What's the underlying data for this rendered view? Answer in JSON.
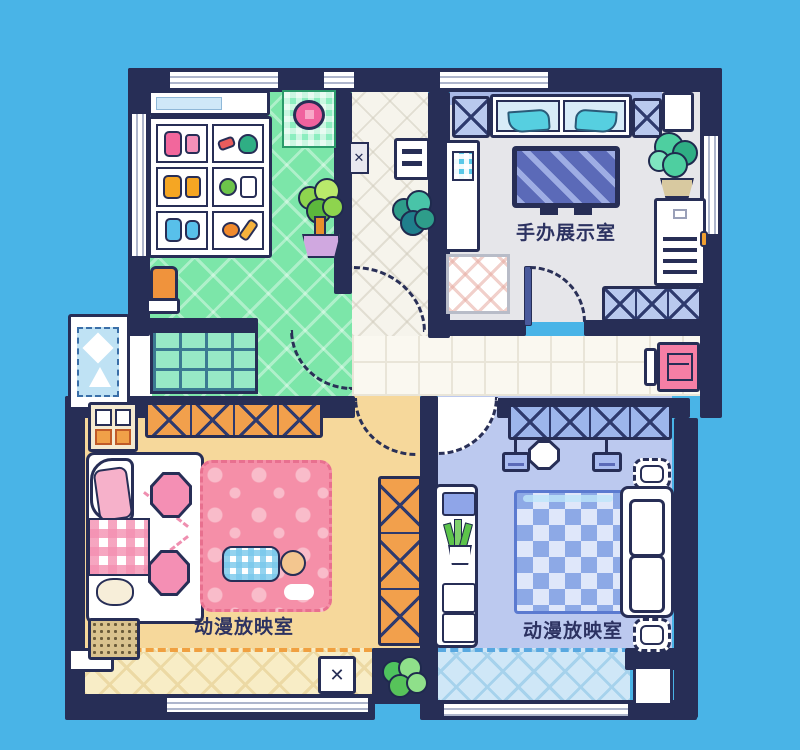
{
  "scene": {
    "type": "pixel-art-apartment-floorplan"
  },
  "labels": {
    "display_room": "手办展示室",
    "screening_room_left": "动漫放映室",
    "screening_room_right": "动漫放映室"
  },
  "glyphs": {
    "x_mark": "✕"
  },
  "colors": {
    "sky": "#49b4e7",
    "wall": "#272e56",
    "kitchen_floor": "#7ce6a9",
    "corridor_floor": "#f6f4ec",
    "display_floor": "#e6e6ea",
    "hall_floor": "#faf8f0",
    "orange_floor": "#f6d89b",
    "orange_balcony": "#f8edc6",
    "blue_floor": "#bcc9ef",
    "blue_balcony": "#cfe7f7",
    "pink_rug": "#f58fa8",
    "blue_rug": "#8da9e6",
    "shelf_orange": "#f2a04c",
    "shelf_blue": "#b9c9ee",
    "accent_pink": "#f67fa5",
    "tv_screen": "#5b6ab8",
    "plant_green": "#8ed44e",
    "plant_teal": "#45cfa8"
  },
  "rooms": [
    {
      "id": "kitchen",
      "furniture": [
        "sink-counter",
        "pantry-shelf",
        "stove-pot",
        "potted-plant",
        "trash-bin",
        "shower-glass-grid",
        "bay-window"
      ]
    },
    {
      "id": "display-room",
      "furniture": [
        "display-case-figures",
        "x-cabinet",
        "tv",
        "vending-cabinet",
        "potted-plant",
        "side-cabinet",
        "rug",
        "x-shelf"
      ]
    },
    {
      "id": "corridor",
      "furniture": [
        "wall-plaque",
        "wall-shelf",
        "potted-plant"
      ]
    },
    {
      "id": "screening-room-left",
      "furniture": [
        "wall-cabinet",
        "x-shelf",
        "bed-sofa",
        "plaid-blanket",
        "pouf-chairs",
        "pink-rug",
        "sleeping-person",
        "doormat",
        "x-shelf-vertical",
        "floor-hatch",
        "balcony"
      ]
    },
    {
      "id": "screening-room-right",
      "furniture": [
        "x-shelf",
        "hanging-lamps",
        "ottomans",
        "blue-rug",
        "couch",
        "desk-with-plant",
        "drawers",
        "balcony"
      ]
    },
    {
      "id": "hallway",
      "furniture": [
        "shoe-cabinet",
        "planter"
      ]
    }
  ]
}
